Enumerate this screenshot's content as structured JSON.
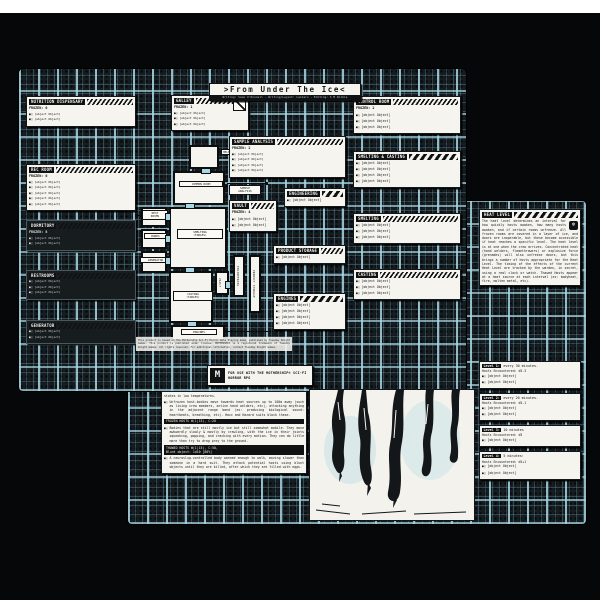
{
  "icons": {
    "bullet": "■□",
    "freeze": "❄",
    "m_logo": "M"
  },
  "colors": {
    "trace_blue": "#a8d6e4",
    "ink": "#0f1113",
    "paper": "#f6f4ee",
    "backdrop": "#060708"
  },
  "page1": {
    "title": ">From Under The Ice<",
    "byline": "Writing: Sean O'Donnell · Writing/Layout: Lazzaro · Editing: S M Wilkie",
    "boxes": {
      "nutrition": {
        "header": "NUTRITION DISPENSARY",
        "frozen": "FROZEN: 0",
        "bullets": [
          "Room-sized food printer in ruin: tangle of hoses, substrate containers, and extrusion nozzles under harsh overhead lighting.",
          "Large tank in front of Bunk entrance."
        ]
      },
      "rec": {
        "header": "REC ROOM",
        "frozen": "FROZEN: 0",
        "bullets": [
          "Beige walled rec space big enough for 20. Framed \"employee of the month\" portraits throughout.",
          "Overturned tables, smashed chairs, couches, & shelves.",
          "Horror movie disks in the ice on the ground. Zombie Night XXIV, ZORBINATION, ROBOBLOOD, Anti-Oedipus: Extended Edition.",
          "Cracked five-foot flatscreen display fallen onto crushed gaming console.",
          "Strewn magazines: KONVICE Dispatch 0002, New Millennium Bloater 17, Interior Calisthenics, Jungbrowsers Organs, Technical Specifications."
        ]
      },
      "dormitory": {
        "header": "DORMITORY",
        "frozen": "FROZEN: 8",
        "bullets": [
          "Collective rest area for one-third of staff, 12 triple-layer bunks in low-lit room.",
          "12 Hosts under the beds, emerging when the room unfreezes. One is still sealed in an Agrisato Mining Co. military uniform, his handprint unlocks the vault."
        ]
      },
      "restrooms": {
        "header": "RESTROOMS",
        "frozen": null,
        "bullets": [
          "Communal tiled shower space, row of toilet stalls & mirrored sinks.",
          "The door is barred with a mop, str + athletics check to open.",
          "Frozen, unoccupied corpse curled up on central drain, nearby shattered mirror over smashed body with crushed slug."
        ]
      },
      "generator": {
        "header": "GENERATOR",
        "frozen": null,
        "bullets": [
          "Dumpster-sized fission reactor under a tangled canopy of connected wires/hoses to be repaired. Requires a jury rigging or mechanical repair check. Crit Failure: Level 2 Irradiation.",
          "Reclimating increases Heat Level by 1."
        ]
      },
      "galley": {
        "header": "GALLEY",
        "frozen": "FROZEN: 1",
        "bullets": [
          "Frozen dead captain hanging from wire noose rotates towards the door when opened.",
          "Walls speckled with blinking control lights & indicators for activated fire protocols.",
          "Black box accessed under the left console."
        ]
      },
      "sample_analysis": {
        "header": "SAMPLE ANALYSIS",
        "frozen": "FROZEN: 2",
        "bullets": [
          "White-walled laboratory space. Large central table with mineral analysis system, surrounded by 10 workstations with advanced microscopes & computers. Core samples on utility carts and lining the walls.",
          "Under central table: Frozen Host, head bent at 90 degrees, partially decapitated, slug emerging from neck wound.",
          "Central computer: analysis of current ore load indicates \"novel impurities\". If looked at more better with photos or something, microscopic larvae and eggs are seen in all samples from the Hold.",
          "Hard drive detailing ore quality from dozens of planets. Worth up to 3mcr to the right person."
        ]
      },
      "engineering": {
        "header": "ENGINEERING",
        "frozen": null,
        "bullets": [
          "Control consoles for life support systems. O2 pressure operating at maintenance levels using emergency reserve power. Heat Level can be raised up to 3 after repairing the generator."
        ]
      },
      "vault": {
        "header": "VAULT",
        "frozen": "FROZEN: 4",
        "bullets": [
          "Opened with security staff handprint.",
          "Central Shelf: 20 Rhodium Ingots (10mcr total)."
        ]
      },
      "product_storage": {
        "header": "PRODUCT STORAGE",
        "frozen": null,
        "bullets": [
          "Cramped & unevenly stacked pallets, forklift at far end. Hundreds of pallets of 90 platinum ingots (1mcr each). Nearly imperceptibly slow movement beneath."
        ]
      },
      "engines": {
        "header": "ENGINES",
        "frozen": null,
        "bullets": [
          "Massive thruster-drive machinery with scattered storage of miscellaneous items throughout.",
          "May be manually activated after repairing the generator, to raise the Heat Level by 1.",
          "Left Wall: Sector Map pin in each system Molten Hearth has been to.",
          "Right Wall: Graffitied list of debts and sources owed (alpha medicine, BSA: tuition, 90%: deposit)."
        ]
      },
      "control_room": {
        "header": "CONTROL ROOM",
        "frozen": "FROZEN: 2",
        "bullets": [
          "Large observatory-style room 20 feet above Smelting & Casting with consoles for automatic and manual control of ore processing systems and cargo hatch airlocks.",
          "Cargo hatch airlocks: if opened will decompress the ship and lose all contents of Hold to space.",
          "Staircases down to Smelting & Casting."
        ]
      },
      "smelting_casting": {
        "header": "SMELTING & CASTING",
        "frozen": null,
        "bullets": [
          "Heat Level 1: sounds of slowly cracking ice and subtle movement in the Hold.",
          "Heat Level 2: Crunching ice and churning movement from the Hold.",
          "Heat Level 3: The smell of stale meat rises from the Hold. Inside is a wet, writhing mass, defrosting hosts crowd Smelting, speed+athletics to navigate without being attacked.",
          "Heat Level 4: Thawed and Frozen Hosts crowd Smelting & it is impossible to pass through without being attacked d5 times."
        ]
      },
      "smelting": {
        "header": "SMELTING",
        "frozen": null,
        "bullets": [
          "Immense blackened metal chamber, roughly 100' across, steel grate floor 10' over the Hold below. Above: vulture-like crane claw and railing system. 3 auto-crucibles the size of deep hot tubs.",
          "Center: 9x9 meter hole into the pit with access ladder. Hosts charge from here by ladder, forming a pyramid of bodies if needed.",
          "Staircase up to the control room."
        ]
      },
      "casting": {
        "header": "CASTING",
        "frozen": null,
        "bullets": [
          "Sprawling metal chamber divided by conveyor belts and cooling chambers over steel grate floor 10' over the Hold.",
          "Staircase up to Control Room.",
          "\"999 days without accident\" sign on the far wall."
        ]
      }
    },
    "map": {
      "rooms": {
        "helm": "HELM",
        "common": "COMMON ROOM",
        "sample": "SAMPLE\nANALYSIS",
        "restrooms": "REST\nROOMS",
        "bunks": "BUNKS",
        "generator": "GENERATOR",
        "smelting": "SMELTING\n(TABLES)",
        "vault": "VAULT",
        "engineering": "ENGINEERING",
        "product": "PRODUCT STORAGE",
        "casting": "CASTING\n(TABLES)",
        "engines": "ENGINES"
      }
    },
    "legal": "This product is based on the Mothership Sci-Fi Horror Role Playing Game, published by Tuesday Knight Games. This product is published under license. MOTHERSHIP is a registered trademark of Tuesday Knight Games. All rights reserved. For additional information, contact Tuesday Knight Games.",
    "badge": {
      "text": "FOR USE WITH THE MOTHERSHIP® SCI-FI HORROR RPG"
    }
  },
  "page2": {
    "heat": {
      "header": "HEAT LEVEL",
      "body": "The heat level determines an interval for how quickly hosts awaken, how many hosts awaken, and if certain rooms unfreeze. All frozen rooms are covered in a layer of ice, and doors are inoperable, but these become accessible if heat reaches a specific level. The heat level is at one when the crew arrives. Concentrated heat (hand welders, flamethrowers) or explosive force (grenades) will also unfreeze doors, but this brings a number of hosts appropriate for the Heat Level. The timing of the effects of the current Heat Level are tracked by the warden, in secret, using a real clock or watch. Thawed Hosts appear at a heat source at each interval (ex: bodyheat, fire, molten metal, etc).",
      "levels": [
        {
          "label": "Level 1:",
          "rate": "every 30 minutes.",
          "hosts": "Hosts Encountered: d5-3",
          "notes": [
            "After sudden or rapid movement, Body check to avoid slipping on the ice and falling down.",
            "Crew without cold protection must body save at [-], on failure they take one damage and gain one stress."
          ]
        },
        {
          "label": "Level 2:",
          "rate": "every 20 minutes.",
          "hosts": "Hosts Encountered: d5-1",
          "notes": [
            "After sudden or rapid movement, Body check to avoid slipping on the ice and falling down.",
            "Crew without cold protection must body save, on failure they take one damage and gain one stress."
          ]
        },
        {
          "label": "Level 3:",
          "rate": "10 minutes",
          "hosts": "Hosts Encountered: d5",
          "notes": [
            "After moving, d5-3 Thawed Hosts in next room."
          ]
        },
        {
          "label": "Level 4:",
          "rate": "5 minutes:",
          "hosts": "Hosts Encountered: d5+1",
          "notes": [
            "After moving, d5 Thawed Hosts in next room.",
            "Crew wearing cold protection must make an exhaustion check/body save or +1 stress and -1 health."
          ]
        }
      ]
    },
    "hosts": {
      "intro_cont": "states in low temperatures.",
      "bullet": "Unfrozen host-bodies move towards heat sources up to 100m away (such as living crew members, active hand welders, etc), attacking anything in the adjacent range band (ex: producing biological sound: heartbeats, breathing, etc). Hacc and Hazard suits block these.",
      "frozen_block": {
        "line1": "FROZEN HOSTS W(1|15), C:20",
        "line2": null,
        "bullet": "Bodies that are still mostly ice but still somewhat mobile. They move awkwardly slowly & mostly by crawling, with the ice in their joints squeaking, popping, and cracking with every motion. They can do little more than try to drag prey to the ground."
      },
      "thawed_block": {
        "line1": "THAWED HOSTS W(1|15), C:50,",
        "line2": "Blunt object: 1d10 [80%]",
        "bullet": "A neuroslug-controlled body warmed enough to walk, moving slower than someone in a hard suit. They attack potential hosts using blunt objects until they are killed, after which they are filled with eggs."
      }
    }
  }
}
